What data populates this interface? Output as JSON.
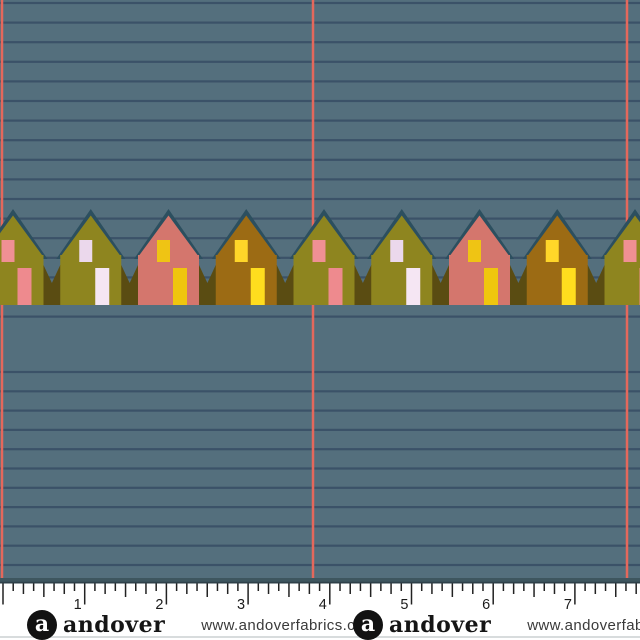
{
  "fabric": {
    "background_color": "#546F7D",
    "stripe_color": "#3B5268",
    "vertical_line_color": "#E4685C",
    "stripes_top": {
      "start_y": 3,
      "step": 19.6,
      "count": 17
    },
    "stripes_bottom": {
      "start_y": 372,
      "step": 19.3,
      "count": 11
    },
    "vertical_lines_x": [
      2,
      313,
      627
    ],
    "houses": {
      "roof_trim_color": "#2C4F5F",
      "hedge_color": "#5A4C12",
      "first_peak_x": 13,
      "peak_spacing": 77.75,
      "count": 9,
      "types": [
        {
          "name": "olive-house-pink-windows",
          "body": "#8E851F",
          "window": "#F09094",
          "door": "#EE8A8E"
        },
        {
          "name": "olive-house-lavender-windows",
          "body": "#8E851F",
          "window": "#EBD8EC",
          "door": "#F5E6F3"
        },
        {
          "name": "salmon-house-yellow-windows",
          "body": "#D4766D",
          "window": "#EFC414",
          "door": "#EFC60E"
        },
        {
          "name": "ochre-house-yellow-windows",
          "body": "#9C6B14",
          "window": "#FFD629",
          "door": "#FFDD1E"
        }
      ]
    }
  },
  "ruler": {
    "numbers": [
      "1",
      "2",
      "3",
      "4",
      "5",
      "6",
      "7"
    ],
    "tick_color": "#222222",
    "number_color": "#1B1B1B",
    "top_band_color": "#3E565F",
    "top_band_edge_color": "#2E4049",
    "start_x": 3,
    "inch_px": 81.7
  },
  "branding": {
    "logo_letter": "a",
    "name": "andover",
    "url": "www.andoverfabrics.com",
    "offsets_x": [
      27,
      353
    ]
  }
}
